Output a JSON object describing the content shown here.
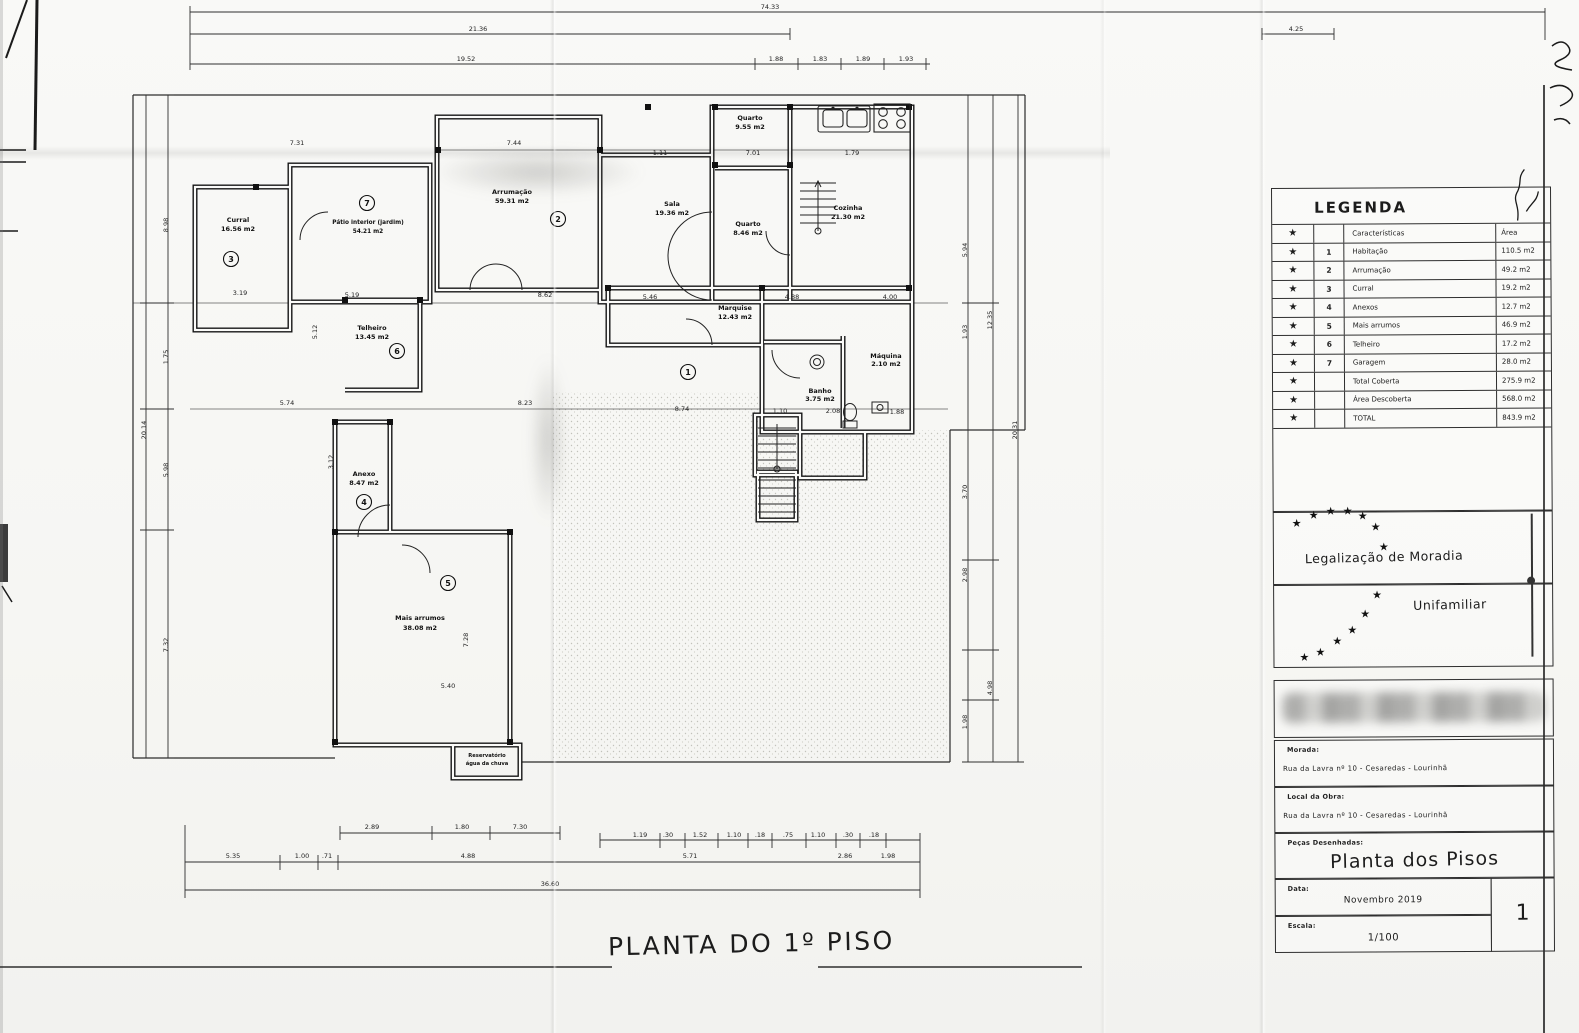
{
  "plan": {
    "sheet_title": "PLANTA DO 1º PISO",
    "rooms": [
      {
        "label": "Curral",
        "area": "16.56 m2",
        "marker": "3"
      },
      {
        "label": "Pátio interior (jardim)",
        "area": "54.21 m2",
        "marker": "7"
      },
      {
        "label": "Arrumação",
        "area": "59.31 m2",
        "marker": "2"
      },
      {
        "label": "Sala",
        "area": "19.36 m2"
      },
      {
        "label": "Quarto",
        "area": "9.55 m2"
      },
      {
        "label": "Quarto",
        "area": "8.46 m2"
      },
      {
        "label": "Cozinha",
        "area": "21.30 m2"
      },
      {
        "label": "Telheiro",
        "area": "13.45 m2",
        "marker": "6"
      },
      {
        "label": "Marquise",
        "area": "12.43 m2"
      },
      {
        "label": "Banho",
        "area": "3.75 m2"
      },
      {
        "label": "Máquina",
        "area": "2.10 m2"
      },
      {
        "label": "Anexo",
        "area": "8.47 m2",
        "marker": "4"
      },
      {
        "label": "Mais arrumos",
        "area": "38.08 m2",
        "marker": "5"
      },
      {
        "label": "Reservatório",
        "area": "água da chuva"
      },
      {
        "marker": "1"
      }
    ]
  },
  "dims": {
    "top": [
      "74.33",
      "21.36",
      "4.25",
      "19.52",
      "1.88",
      "1.83",
      "1.89",
      "1.93"
    ],
    "inner": [
      "7.31",
      "7.44",
      "1.11",
      "7.01",
      "1.79",
      "3.19",
      "5.19",
      "8.62",
      "5.46",
      "4.88",
      "4.00",
      "5.74",
      "8.23",
      "8.74",
      "1.10",
      "2.08",
      "1.88",
      "5.40",
      "7.28",
      "5.12",
      "3.12"
    ],
    "left": [
      "20.14",
      "8.98",
      "1.75",
      "5.98",
      "7.32"
    ],
    "right": [
      "5.94",
      "1.93",
      "12.35",
      "20.31",
      "3.70",
      "2.98",
      "4.98",
      "1.98"
    ],
    "bottom": [
      "2.89",
      "1.80",
      "7.30",
      "5.35",
      "1.00",
      ".71",
      "4.88",
      "5.71",
      "2.86",
      "1.98",
      "36.60"
    ],
    "bsmall": [
      "1.19",
      ".30",
      "1.52",
      "1.10",
      ".18",
      ".75",
      "1.10",
      ".30",
      ".18"
    ]
  },
  "legend": {
    "title": "LEGENDA",
    "star_glyph": "★",
    "rows": [
      {
        "num": "",
        "name": "Características",
        "area": "Área"
      },
      {
        "num": "1",
        "name": "Habitação",
        "area": "110.5 m2"
      },
      {
        "num": "2",
        "name": "Arrumação",
        "area": "49.2 m2"
      },
      {
        "num": "3",
        "name": "Curral",
        "area": "19.2 m2"
      },
      {
        "num": "4",
        "name": "Anexos",
        "area": "12.7 m2"
      },
      {
        "num": "5",
        "name": "Mais arrumos",
        "area": "46.9 m2"
      },
      {
        "num": "6",
        "name": "Telheiro",
        "area": "17.2 m2"
      },
      {
        "num": "7",
        "name": "Garagem",
        "area": "28.0 m2"
      },
      {
        "num": "",
        "name": "Total Coberta",
        "area": "275.9 m2"
      },
      {
        "num": "",
        "name": "Área Descoberta",
        "area": "568.0 m2"
      },
      {
        "num": "",
        "name": "TOTAL",
        "area": "843.9 m2"
      }
    ]
  },
  "stamp": {
    "line1": "Legalização de Moradia",
    "line2": "Unifamiliar"
  },
  "title_block": {
    "morada_label": "Morada:",
    "morada_value": "Rua da Lavra nº 10  -  Cesaredas  -  Lourinhã",
    "obra_label": "Local da Obra:",
    "obra_value": "Rua da Lavra nº 10  -  Cesaredas  -  Lourinhã",
    "pecas_label": "Peças Desenhadas:",
    "pecas_value": "Planta dos Pisos",
    "data_label": "Data:",
    "data_value": "Novembro 2019",
    "escala_label": "Escala:",
    "escala_value": "1/100",
    "sheet_number": "1"
  }
}
